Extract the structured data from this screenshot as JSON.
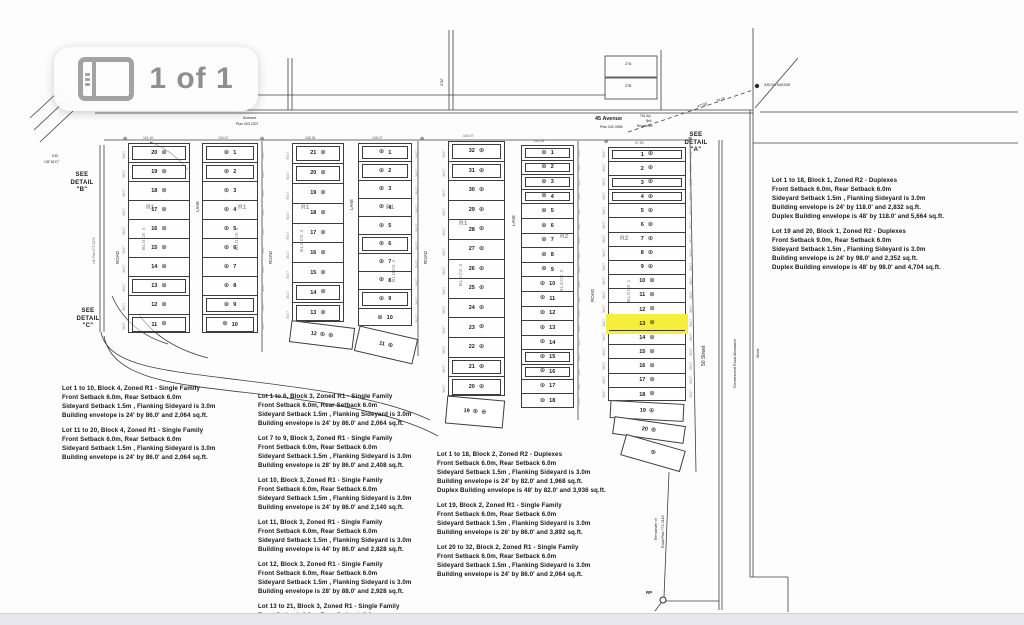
{
  "viewer": {
    "badge_count": "1 of 1",
    "badge_icon": "gallery-icon"
  },
  "plat": {
    "streets": {
      "avenue_top": "Avenue",
      "avenue_top_plan": "Plan 003 2307",
      "avenue_45": "45 Avenue",
      "avenue_45_plan": "Plan 042 0056",
      "street_50": "50 Street",
      "gov_road_allowance": "Government Road Allowance",
      "street_right": "Street",
      "road": "ROAD",
      "lane": "LANE",
      "lith_plan": "Lith Plan 072 2070",
      "remainder_line1": "Remainder of",
      "remainder_line2": "Road Plan 772 2119",
      "rp": "RP",
      "ascm": "ASCM 940305",
      "easement": [
        "T61 AA",
        "Bell",
        "Registered"
      ],
      "stat": "STAT",
      "box_27a": "27A",
      "box_27b": "27B"
    },
    "details": {
      "a": [
        "SEE",
        "DETAIL",
        "\"A\""
      ],
      "b": [
        "SEE",
        "DETAIL",
        "\"B\""
      ],
      "c": [
        "SEE",
        "DETAIL",
        "\"C\""
      ]
    },
    "bearing": {
      "angle": "47°30'",
      "distance": "75.19"
    },
    "corner_note": [
      "6.52",
      "135°18'47\""
    ],
    "symbols": {
      "survey_marker": "⊕"
    },
    "highlight_color": "#f5ee3a",
    "blocks": {
      "block4": {
        "label": "BLOCK 4",
        "zone": "R1",
        "left": [
          "20",
          "19",
          "18",
          "17",
          "16",
          "15",
          "14",
          "13",
          "12",
          "11"
        ],
        "right": [
          "1",
          "2",
          "3",
          "4",
          "5",
          "6",
          "7",
          "8",
          "9",
          "10"
        ]
      },
      "block3": {
        "label": "BLOCK 3",
        "zone": "R1",
        "left": [
          "21",
          "20",
          "19",
          "18",
          "17",
          "16",
          "15",
          "14",
          "13"
        ],
        "left_angled": "12",
        "right": [
          "1",
          "2",
          "3",
          "4",
          "5",
          "6",
          "7",
          "8",
          "9",
          "10"
        ],
        "right_angled": "11"
      },
      "block2": {
        "label": "BLOCK 2",
        "zone_left": "R1",
        "zone_right": "R2",
        "left": [
          "32",
          "31",
          "30",
          "29",
          "28",
          "27",
          "26",
          "25",
          "24",
          "23",
          "22",
          "21",
          "20"
        ],
        "left_angled": "19",
        "right": [
          "1",
          "2",
          "3",
          "4",
          "5",
          "6",
          "7",
          "8",
          "9",
          "10",
          "11",
          "12",
          "13",
          "14",
          "15",
          "16",
          "17",
          "18"
        ]
      },
      "block1": {
        "label": "BLOCK 1",
        "zone": "R2",
        "lots": [
          "1",
          "2",
          "3",
          "4",
          "5",
          "6",
          "7",
          "8",
          "9",
          "10",
          "11",
          "12",
          "13",
          "14",
          "15",
          "16",
          "17",
          "18"
        ],
        "angled": [
          "19",
          "20"
        ],
        "highlight_lot": "13"
      }
    },
    "dims": {
      "b4l": "114.10",
      "b4r": "104.07",
      "b3l": "108.36",
      "b3r": "106.07",
      "b2l": "104.07",
      "b2r": "121.92",
      "b1": "97.53",
      "tick": "36.07",
      "d1": "53.26",
      "d2": "27.23",
      "d3": "20.5",
      "d4": "21°"
    },
    "notes": {
      "left": [
        [
          "Lot 1 to 10, Block 4, Zoned R1 - Single Family",
          "Front Setback 6.0m, Rear Setback 6.0m",
          "Sideyard Setback 1.5m , Flanking Sideyard is 3.0m",
          "Building envelope is 24' by 86.0' and 2,064 sq.ft."
        ],
        [
          "Lot 11 to 20, Block 4, Zoned R1 - Single Family",
          "Front Setback 6.0m, Rear Setback 6.0m",
          "Sideyard Setback 1.5m , Flanking Sideyard is 3.0m",
          "Building envelope is 24' by 86.0' and 2,064 sq.ft."
        ]
      ],
      "middle": [
        [
          "Lot 1 to 6, Block 3, Zoned R1 - Single Family",
          "Front Setback 6.0m, Rear Setback 6.0m",
          "Sideyard Setback 1.5m , Flanking Sideyard is 3.0m",
          "Building envelope is 24' by 86.0' and 2,064 sq.ft."
        ],
        [
          "Lot 7 to 9, Block 3, Zoned R1 - Single Family",
          "Front Setback 6.0m, Rear Setback 6.0m",
          "Sideyard Setback 1.5m , Flanking Sideyard is 3.0m",
          "Building envelope is 28' by 86.0' and 2,408 sq.ft."
        ],
        [
          "Lot 10, Block 3, Zoned R1 - Single Family",
          "Front Setback 6.0m, Rear Setback 6.0m",
          "Sideyard Setback 1.5m , Flanking Sideyard is 3.0m",
          "Building envelope is 24' by 86.0' and 2,140 sq.ft."
        ],
        [
          "Lot 11, Block 3, Zoned R1 - Single Family",
          "Front Setback 6.0m, Rear Setback 6.0m",
          "Sideyard Setback 1.5m , Flanking Sideyard is 3.0m",
          "Building envelope is 44' by 86.0' and 2,828 sq.ft."
        ],
        [
          "Lot 12, Block 3, Zoned R1 - Single Family",
          "Front Setback 6.0m, Rear Setback 6.0m",
          "Sideyard Setback 1.5m , Flanking Sideyard is 3.0m",
          "Building envelope is 28' by 88.0' and 2,928 sq.ft."
        ],
        [
          "Lot 13 to 21, Block 3, Zoned R1 - Single Family",
          "Front Setback 6.0m, Rear Setback 6.0m",
          "Sideyard Setback 1.5m , Flanking Sideyard is 3.0m"
        ]
      ],
      "center": [
        [
          "Lot 1 to 18, Block 2, Zoned R2 - Duplexes",
          "Front Setback 6.0m, Rear Setback 6.0m",
          "Sideyard Setback 1.5m , Flanking Sideyard is 3.0m",
          "Building envelope is 24' by 82.0' and 1,968 sq.ft.",
          "Duplex Building envelope is 48' by 82.0' and 3,936 sq.ft."
        ],
        [
          "Lot 19, Block 2, Zoned R1 - Single Family",
          "Front Setback 6.0m, Rear Setback 6.0m",
          "Sideyard Setback 1.5m , Flanking Sideyard is 3.0m",
          "Building envelope is 26' by 86.0' and 3,892 sq.ft."
        ],
        [
          "Lot 20 to 32, Block 2, Zoned R1 - Single Family",
          "Front Setback 6.0m, Rear Setback 6.0m",
          "Sideyard Setback 1.5m , Flanking Sideyard is 3.0m",
          "Building envelope is 24' by 86.0' and 2,064 sq.ft."
        ]
      ],
      "right": [
        [
          "Lot 1 to 18, Block 1, Zoned R2 - Duplexes",
          "Front Setback 6.0m, Rear Setback 6.0m",
          "Sideyard Setback 1.5m , Flanking Sideyard is 3.0m",
          "Building envelope is 24' by 118.0' and 2,832 sq.ft.",
          "Duplex Building envelope is 48' by 118.0' and 5,664 sq.ft."
        ],
        [
          "Lot 19 and 20, Block 1, Zoned R2 - Duplexes",
          "Front Setback 9.0m, Rear Setback 6.0m",
          "Sideyard Setback 1.5m , Flanking Sideyard is 3.0m",
          "Building envelope is 24' by 98.0' and 2,352 sq.ft.",
          "Duplex Building envelope is 48' by 98.0' and 4,704 sq.ft."
        ]
      ]
    }
  }
}
